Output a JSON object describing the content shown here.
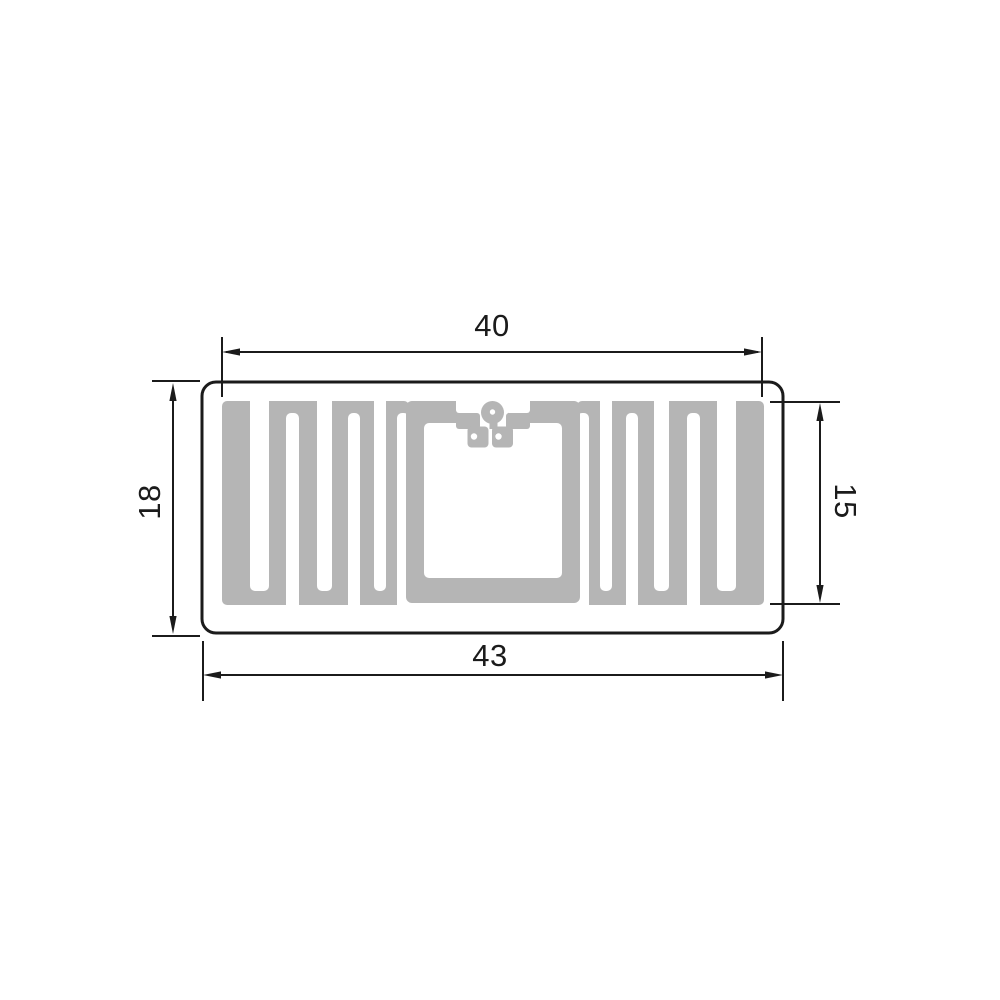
{
  "drawing": {
    "dimensions": {
      "top_width": "40",
      "bottom_width": "43",
      "left_height": "18",
      "right_height": "15"
    },
    "colors": {
      "antenna": "#b5b5b5",
      "line": "#1b1b1b",
      "background": "#ffffff"
    }
  }
}
